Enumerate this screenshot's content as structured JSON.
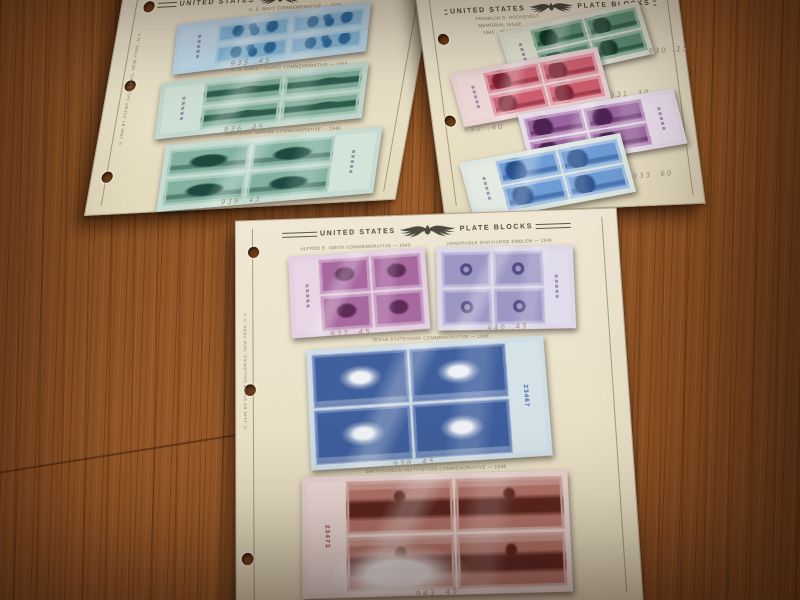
{
  "scene": {
    "description": "Photograph of three United States Plate Blocks stamp-album pages lying on a brown wood-grain table",
    "palette": {
      "wood": "#8f5526",
      "page_paper": "#ece3cc",
      "mount_black": "#151515",
      "navy_blue": "#86b9d9",
      "coast_guard_green": "#7eab97",
      "merchant_marine_green": "#83b2a0",
      "fdr_green": "#5e9478",
      "fdr_carmine": "#d06071",
      "fdr_purple": "#9a64a0",
      "fdr_blue": "#6f9cd4",
      "smith_purple": "#a868a0",
      "discharge_violet": "#9d97c4",
      "texas_blue": "#3f5f9d",
      "smithsonian_brown": "#b4756b"
    }
  },
  "header": {
    "left": "UNITED STATES",
    "right": "PLATE BLOCKS",
    "emblem": "eagle-emblem"
  },
  "pages": {
    "left": {
      "imprint": "© 1946 BY STAMP GALLERIES, NEW YORK, N.Y.",
      "blocks": [
        {
          "subject": "navy-sailors-light-blue-block",
          "caption": "U. S. NAVY COMMEMORATIVE — 1945",
          "pencil_note": "935  .45"
        },
        {
          "subject": "coast-guard-blue-green-block",
          "caption": "U. S. COAST GUARD COMMEMORATIVE — 1945",
          "pencil_note": "936  .45"
        },
        {
          "subject": "merchant-marine-ship-block",
          "caption": "MERCHANT MARINE COMMEMORATIVE — 1946",
          "pencil_note": "939  .45"
        }
      ]
    },
    "right": {
      "series_caption": [
        "FRANKLIN D. ROOSEVELT",
        "MEMORIAL ISSUE",
        "1945 - 46"
      ],
      "blocks": [
        {
          "subject": "roosevelt-green-block",
          "pencil_note": "930  .25"
        },
        {
          "subject": "roosevelt-carmine-block",
          "pencil_note": "931  .30"
        },
        {
          "subject": "roosevelt-purple-block",
          "pencil_note": "932  .40"
        },
        {
          "subject": "roosevelt-blue-block",
          "pencil_note": "933  .60"
        }
      ]
    },
    "center": {
      "imprint": "© 1946 BY STAMP GALLERIES, NEW YORK, N.Y.",
      "blocks": [
        {
          "subject": "alfred-smith-purple-block",
          "caption": "ALFRED E. SMITH COMMEMORATIVE — 1945",
          "plate_number": "",
          "pencil_note": "937  .45"
        },
        {
          "subject": "honorable-discharge-violet-block",
          "caption": "HONORABLE DISCHARGE EMBLEM — 1946",
          "plate_number": "",
          "pencil_note": "940  .45"
        },
        {
          "subject": "texas-statehood-blue-block",
          "caption": "TEXAS STATEHOOD COMMEMORATIVE — 1945",
          "plate_number": "23467",
          "pencil_note": "938  .45"
        },
        {
          "subject": "smithsonian-red-brown-block",
          "caption": "SMITHSONIAN INSTITUTION COMMEMORATIVE — 1946",
          "plate_number": "23473",
          "pencil_note": "943  .45"
        }
      ]
    }
  }
}
